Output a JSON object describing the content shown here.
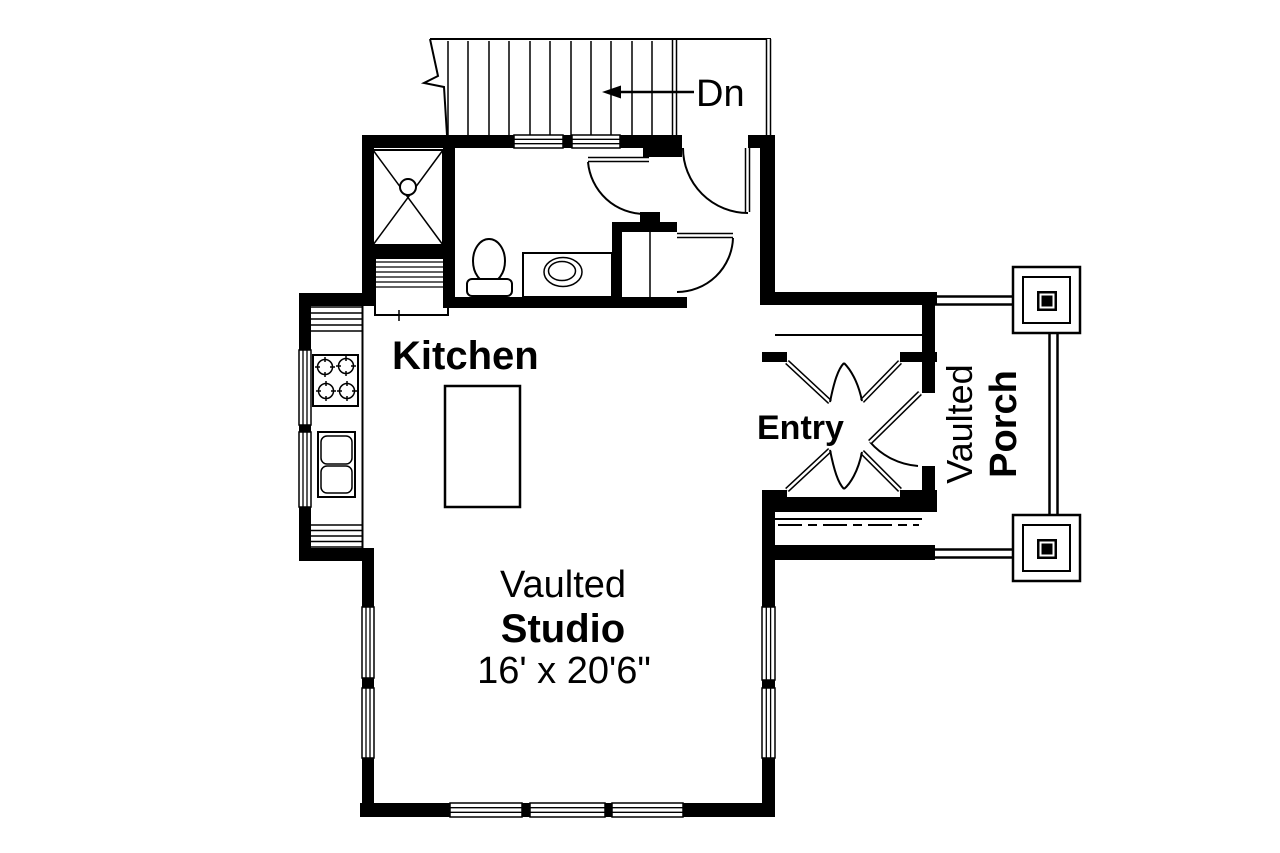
{
  "plan": {
    "stairs": {
      "label": "Dn"
    },
    "kitchen": {
      "label": "Kitchen"
    },
    "entry": {
      "label": "Entry"
    },
    "porch": {
      "line1": "Vaulted",
      "line2": "Porch"
    },
    "studio": {
      "line1": "Vaulted",
      "line2": "Studio",
      "dimensions": "16' x 20'6\""
    }
  },
  "fixtures": [
    "staircase",
    "down-arrow",
    "shower",
    "toilet",
    "vanity-sink",
    "closet",
    "refrigerator",
    "range-stove",
    "double-kitchen-sink",
    "kitchen-island",
    "entry-french-doors",
    "front-door",
    "porch-columns"
  ],
  "colors": {
    "walls": "#000000",
    "background": "#ffffff",
    "text": "#000000"
  }
}
